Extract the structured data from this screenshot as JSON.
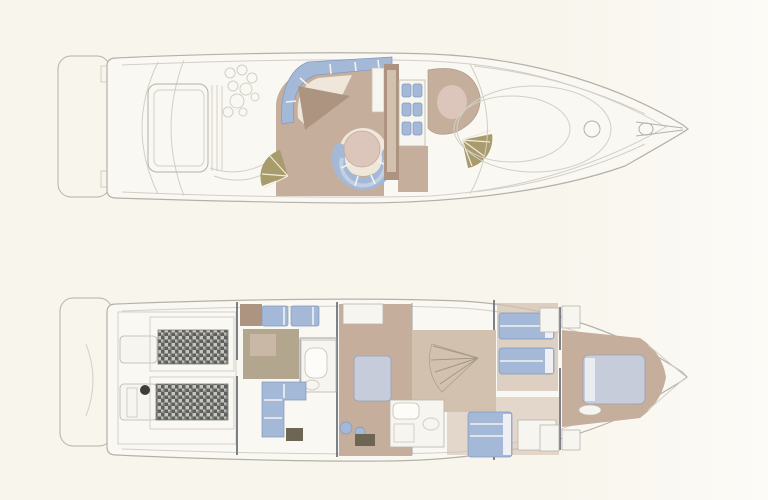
{
  "figure": {
    "kind": "yacht-floor-plan",
    "views": [
      "main-deck-top-view",
      "lower-deck-top-view"
    ],
    "orientation": "bow-right-stern-left",
    "visible_text": ""
  },
  "palette": {
    "bg": "#f8f5ec",
    "bg2": "#fcfbf7",
    "hull": "#faf8f2",
    "line": "#b5b1a8",
    "line_light": "#d2cfc6",
    "wall": "#6f757c",
    "tan": "#c5ae9c",
    "tan_light": "#d3c1b0",
    "tan_dark": "#ad9480",
    "olive": "#b2a68e",
    "blue": "#a4b8d7",
    "blue_light": "#c3cfe2",
    "blue_gray": "#c6ccda",
    "white": "#f7f5ef",
    "cream": "#efe8da",
    "pink": "#dcc5ba",
    "khaki": "#a89b6c",
    "engine_dark": "#5f5f5d",
    "engine_mid": "#8d8d89",
    "engine_light": "#c6c6c0",
    "table_dark": "#6e6654"
  },
  "main_deck": {
    "label": "main-deck",
    "features": [
      "swim-platform",
      "transom",
      "engine-hatch",
      "cockpit-table",
      "salon-settee",
      "dinette-round-table",
      "dinette-seating",
      "wet-bar-appliances",
      "helm-seat",
      "windshield",
      "foredeck",
      "bow-hatch",
      "anchor-fitting"
    ]
  },
  "lower_deck": {
    "label": "lower-deck",
    "features": [
      "swim-platform",
      "engine-room",
      "port-engine",
      "starboard-engine",
      "aft-cabin-berth",
      "aft-head",
      "aft-sofa",
      "galley-floor",
      "dinette-island",
      "companionway-stairs",
      "day-head",
      "mid-cabin-bed",
      "twin-guest-beds",
      "forward-vip-bed",
      "forward-closets",
      "bow"
    ]
  }
}
